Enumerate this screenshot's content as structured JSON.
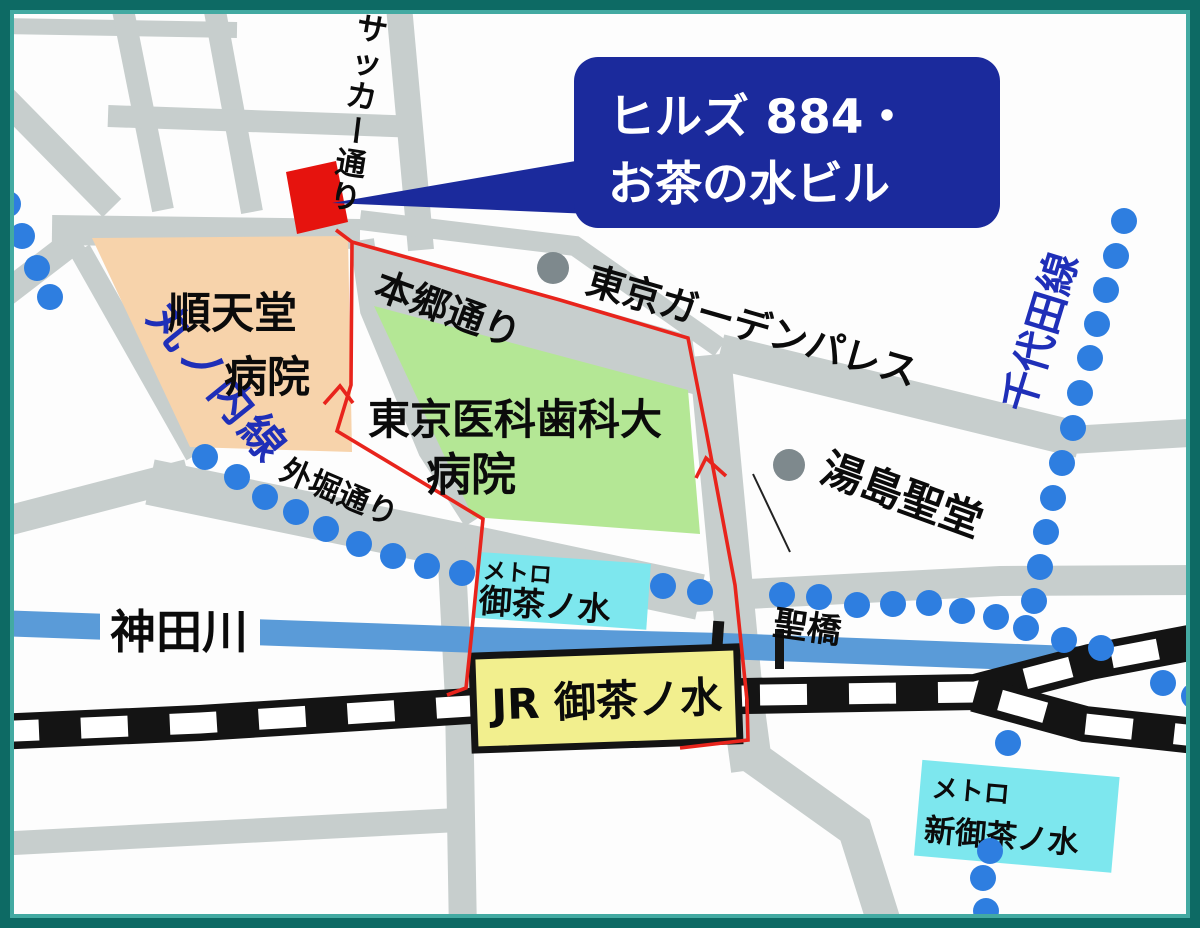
{
  "map": {
    "callout": {
      "line1": "ヒルズ 884・",
      "line2": "お茶の水ビル"
    },
    "streets": {
      "soccer": "サッカー通り",
      "hongo": "本郷通り",
      "sotobori": "外堀通り"
    },
    "railway_lines": {
      "marunouchi": "丸ノ内線",
      "chiyoda": "千代田線"
    },
    "places": {
      "juntendo_line1": "順天堂",
      "juntendo_line2": "病院",
      "tmd_line1": "東京医科歯科大",
      "tmd_line2": "病院",
      "garden_palace": "東京ガーデンパレス",
      "yushima_seido": "湯島聖堂",
      "kanda_river": "神田川",
      "hijiribashi": "聖橋"
    },
    "stations": {
      "metro_ochanomizu": {
        "prefix": "メトロ",
        "name": "御茶ノ水"
      },
      "jr_ochanomizu": {
        "name": "JR 御茶ノ水"
      },
      "metro_shin_ochanomizu": {
        "prefix": "メトロ",
        "name": "新御茶ノ水"
      }
    },
    "colors": {
      "border_outer": "#0d6a64",
      "border_inner": "#43aaa2",
      "road": "#c7cecd",
      "river": "#5a9bd8",
      "rail": "#141414",
      "dot_blue": "#2e7ee0",
      "line_text_blue": "#1f2fb8",
      "gray_dot": "#7e898d",
      "building_red": "#e6130e",
      "route_red": "#e8241c",
      "callout_blue": "#1b2a9c",
      "hospital_peach": "#f7d3ab",
      "hospital_green": "#b4e795",
      "metro_cyan": "#7de7ee",
      "jr_yellow": "#f2ef8e"
    }
  }
}
